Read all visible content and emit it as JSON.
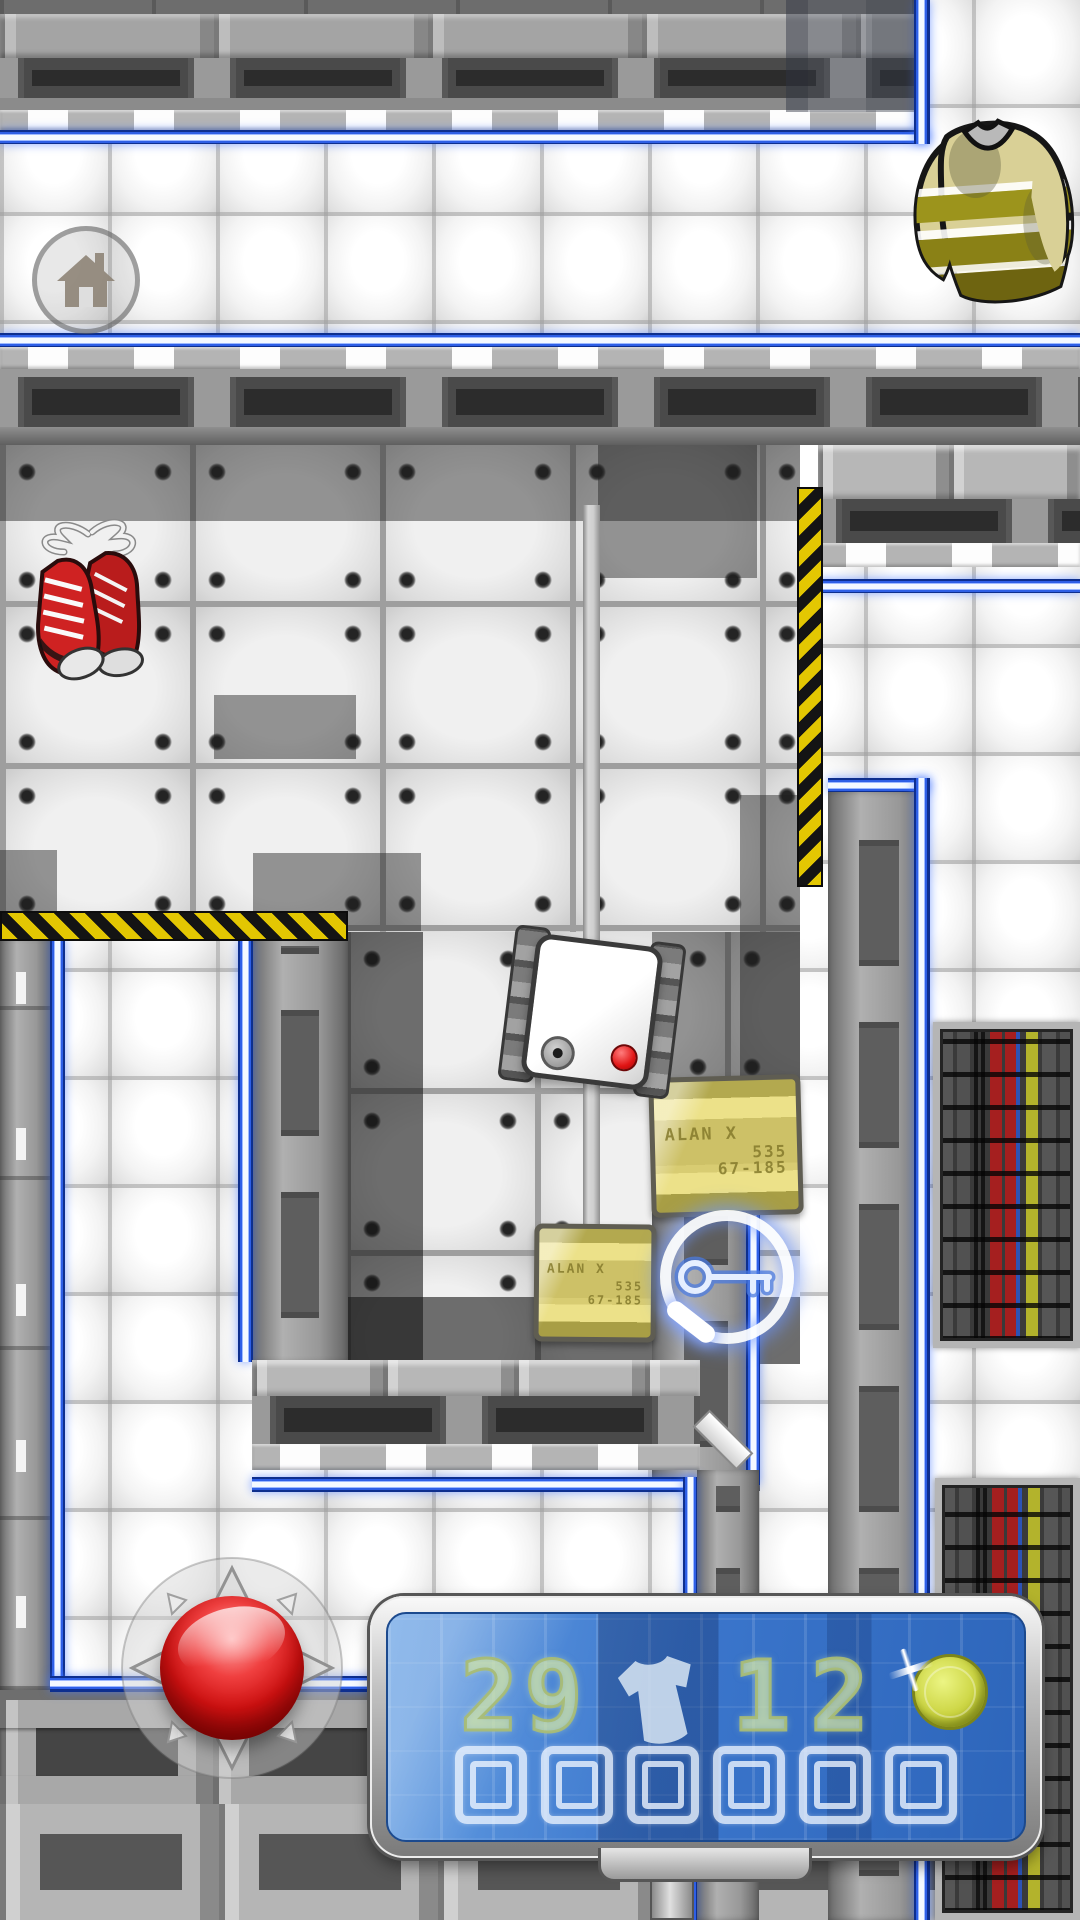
{
  "hud": {
    "shirts_remaining": "29",
    "gems_remaining": "12",
    "score": "000000",
    "score_digits": [
      "0",
      "0",
      "0",
      "0",
      "0",
      "0"
    ],
    "screen_color": "#3b76cc",
    "digit_color": "#cfe0a8"
  },
  "crate": {
    "line1": "ALAN X",
    "line2": "535",
    "line3": "67-185"
  },
  "icons": {
    "home": "home-icon",
    "hud_shirt": "t-shirt-icon",
    "hud_coin": "coin-icon",
    "pickup_key": "key-icon",
    "pickup_sneakers": "sneakers",
    "pickup_sweater": "sweater",
    "joystick": "joystick-red-ball"
  },
  "colors": {
    "neon_blue": "#2e5fe6",
    "hazard_yellow": "#e3c702",
    "joystick_red": "#cf1111",
    "coin_green": "#cbd441",
    "crate_khaki": "#cdc167"
  }
}
